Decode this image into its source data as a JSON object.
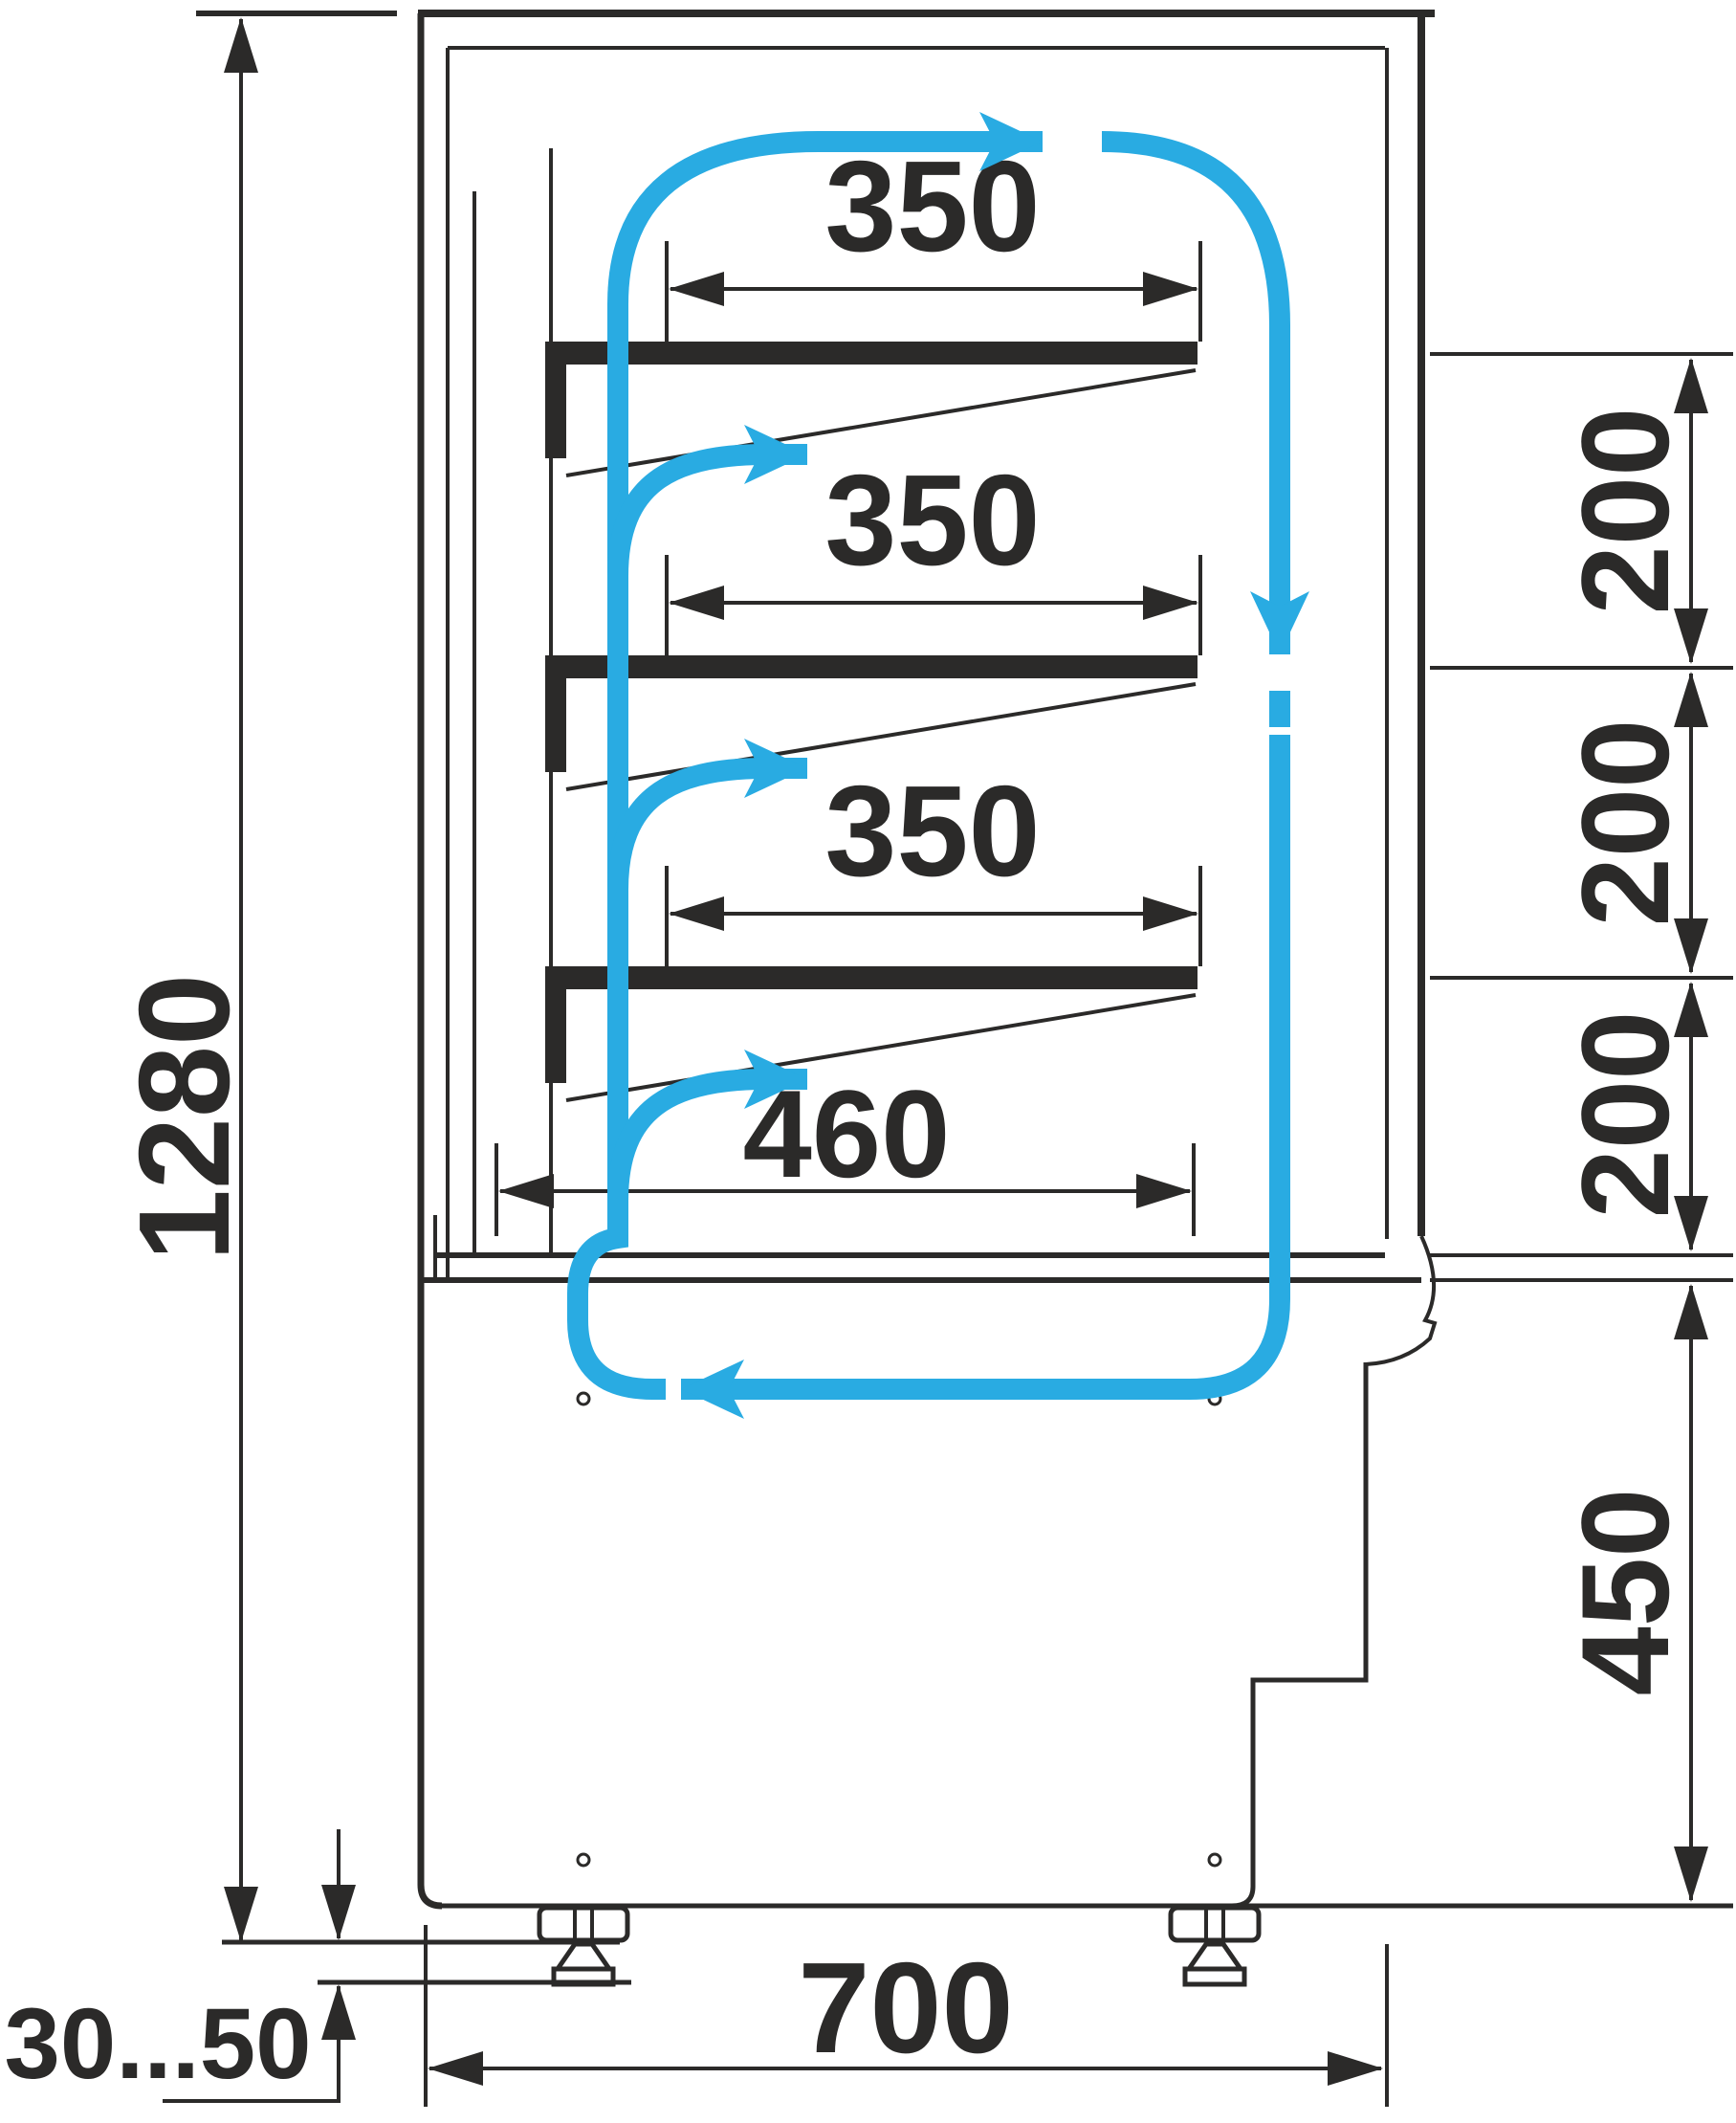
{
  "diagram": {
    "title": "display-case-airflow-schematic",
    "colors": {
      "line": "#2b2a29",
      "airflow": "#29abe2",
      "background": "#ffffff"
    },
    "dimensions": {
      "overall_height": "1280",
      "shelf_1_depth": "350",
      "shelf_2_depth": "350",
      "shelf_3_depth": "350",
      "bottom_shelf_depth": "460",
      "shelf_gap_1": "200",
      "shelf_gap_2": "200",
      "shelf_gap_3": "200",
      "base_section_height": "450",
      "base_depth": "700",
      "foot_adjustment_range": "30...50"
    },
    "airflow": {
      "pattern": "clockwise circulation loop with per-shelf outlets",
      "arrows": [
        "top-flow-right",
        "right-flow-down",
        "shelf-1-outlet-right",
        "shelf-2-outlet-right",
        "shelf-3-outlet-right",
        "bottom-return-left"
      ]
    }
  }
}
